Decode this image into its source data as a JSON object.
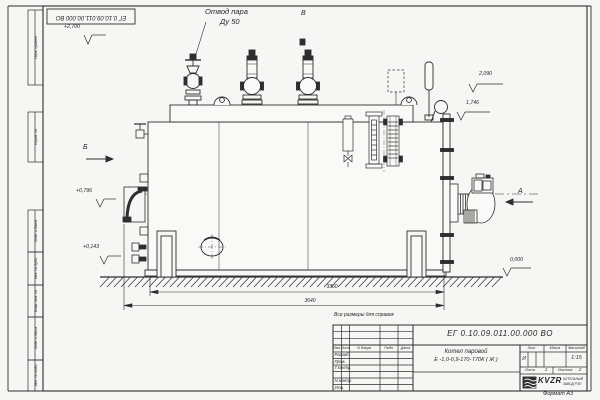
{
  "page": {
    "doc_number_top": "ЕГ 0.10.09.011.00.000  ВО",
    "reference_note": "Все размеры для справок",
    "format_note": "Формат А3"
  },
  "annotations": {
    "steam_outlet_line1": "Отвод пара",
    "steam_outlet_line2": "Ду 50",
    "view_top": "В",
    "view_left": "Б",
    "view_right": "А"
  },
  "elevation_marks": {
    "top": "+2,700",
    "right_upper": "2,090",
    "right_mid": "1,746",
    "left_mid": "+0,796",
    "left_low": "+0,143",
    "ground": "0,000"
  },
  "dimensions": {
    "body_length": "3360",
    "overall_length": "3640"
  },
  "side_column_labels": [
    "Перв. примен.",
    "Справ. №",
    "Подп. и дата",
    "Инв. № дубл.",
    "Взам. инв. №",
    "Подп. и дата",
    "Инв. № подл."
  ],
  "title_block": {
    "doc_number": "ЕГ 0.10.09.011.00.000  ВО",
    "product_line1": "Котел паровой",
    "product_line2": "Е -1,0-0,9-170- ГЛЖ ( Ж )",
    "col_izm": "Изм.",
    "col_list": "Лист",
    "col_doc": "N докум.",
    "col_sign": "Подп.",
    "col_date": "Дата",
    "row_developed": "Разраб.",
    "row_checked": "Пров.",
    "row_tcontrol": "Т.контр.",
    "row_ncontrol": "Н.контр.",
    "row_approved": "Утв.",
    "lit_label": "Лит.",
    "mass_label": "Масса",
    "scale_label": "Масштаб",
    "lit_value": "И",
    "scale_value": "1:15",
    "sheet_label": "Лист",
    "sheet_number": "1",
    "sheets_label": "Листов",
    "sheets_total": "2",
    "company_logo": "KVZR",
    "company_line1": "КОТЕЛЬНЫЙ",
    "company_line2": "ЗАВОД РЭП"
  },
  "colors": {
    "line": "#2e2e2e",
    "paper": "#f6f6f4"
  }
}
